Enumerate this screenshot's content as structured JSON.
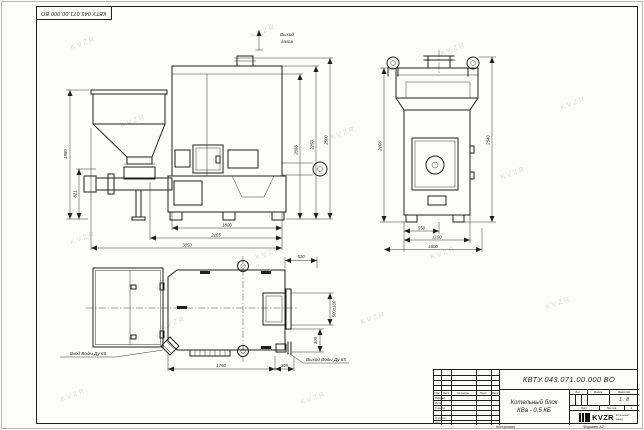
{
  "meta": {
    "sheet_bg": "#fcfcfb",
    "line_color": "#1f1f1f",
    "watermark_text": "KVZR"
  },
  "stamp_top": {
    "doc_number_inverted": "КВТУ.043.071.00.000 ВО"
  },
  "views": {
    "front": {
      "flue_label_line1": "Выход",
      "flue_label_line2": "газов",
      "dim_left_outer": "1980",
      "dim_left_inner": "821",
      "dim_right_inner": "2086",
      "dim_right_mid": "2250",
      "dim_right_outer": "2500",
      "dim_bottom_inner": "1800",
      "dim_bottom_mid": "2165",
      "dim_bottom_outer": "3050"
    },
    "side": {
      "dim_left": "2166",
      "dim_right": "2540",
      "dim_bottom_inner": "550",
      "dim_bottom_mid": "1100",
      "dim_bottom_outer": "1600"
    },
    "plan": {
      "dim_top_right": "520",
      "dim_right_upper": "500±100",
      "dim_right_lower": "300",
      "dim_bottom_main": "1750",
      "dim_bottom_right": "305",
      "inlet_label": "Вход Воды Ду 65",
      "outlet_label": "Выход Воды Ду 65"
    }
  },
  "title_block": {
    "doc_number": "КВТУ.043.071.00.000 ВО",
    "product_name_line1": "Котельный блок",
    "product_name_line2": "КВа - 0,5 КБ",
    "header_cells": [
      "Изм.",
      "Лист",
      "№ докум.",
      "Подп.",
      "Дата"
    ],
    "row_labels": [
      "Разраб.",
      "Пров.",
      "Т.контр.",
      "",
      "Н.контр.",
      "Утв."
    ],
    "lit_header": [
      "Лит.",
      "Масса",
      "Масштаб"
    ],
    "scale_value": "1 : 8",
    "sheet_label": "Лист",
    "sheets_label": "Листов",
    "sheets_value": "1",
    "logo_text": "KVZR",
    "logo_sub_line1": "Котельный",
    "logo_sub_line2": "завод",
    "footer_copy": "Копировал",
    "footer_format": "Формат А2"
  }
}
